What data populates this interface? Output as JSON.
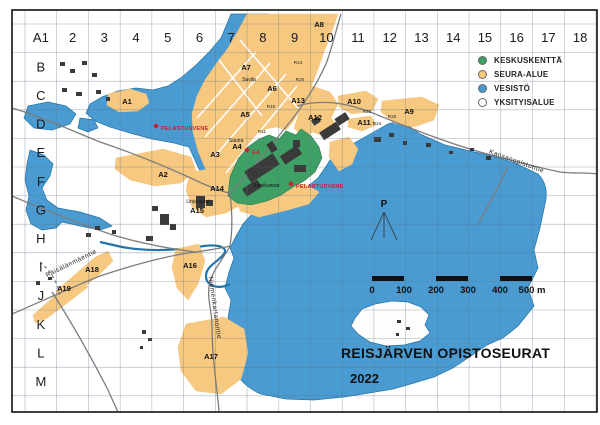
{
  "page": {
    "title_line": "REISJÄRVEN OPISTOSEURAT",
    "year": "2022"
  },
  "grid": {
    "columns": [
      "A1",
      "2",
      "3",
      "4",
      "5",
      "6",
      "7",
      "8",
      "9",
      "10",
      "11",
      "12",
      "13",
      "14",
      "15",
      "16",
      "17",
      "18"
    ],
    "rows": [
      "B",
      "C",
      "D",
      "E",
      "F",
      "G",
      "H",
      "I",
      "J",
      "K",
      "L",
      "M"
    ]
  },
  "legend": {
    "items": [
      {
        "label": "KESKUSKENTTÄ",
        "color": "#3fa065"
      },
      {
        "label": "SEURA-ALUE",
        "color": "#f6c880"
      },
      {
        "label": "VESISTÖ",
        "color": "#4a9bd1"
      },
      {
        "label": "YKSITYISALUE",
        "color": "#ffffff"
      }
    ]
  },
  "scale_bar": {
    "labels": [
      "0",
      "100",
      "200",
      "300",
      "400",
      "500 m"
    ]
  },
  "north_marker": {
    "label": "P",
    "x": 384,
    "y": 207
  },
  "map_labels": {
    "areas": [
      {
        "text": "A1",
        "x": 127,
        "y": 104
      },
      {
        "text": "A2",
        "x": 163,
        "y": 177
      },
      {
        "text": "A3",
        "x": 215,
        "y": 157
      },
      {
        "text": "A4",
        "x": 237,
        "y": 149
      },
      {
        "text": "A5",
        "x": 245,
        "y": 117
      },
      {
        "text": "A6",
        "x": 272,
        "y": 91
      },
      {
        "text": "A7",
        "x": 246,
        "y": 70
      },
      {
        "text": "A8",
        "x": 319,
        "y": 27
      },
      {
        "text": "A9",
        "x": 409,
        "y": 114
      },
      {
        "text": "A10",
        "x": 354,
        "y": 104
      },
      {
        "text": "A11",
        "x": 364,
        "y": 125
      },
      {
        "text": "A12",
        "x": 315,
        "y": 120
      },
      {
        "text": "A13",
        "x": 298,
        "y": 103
      },
      {
        "text": "A14",
        "x": 217,
        "y": 191
      },
      {
        "text": "A15",
        "x": 197,
        "y": 213
      },
      {
        "text": "A16",
        "x": 190,
        "y": 268
      },
      {
        "text": "A17",
        "x": 211,
        "y": 359
      },
      {
        "text": "A18",
        "x": 92,
        "y": 272
      },
      {
        "text": "A19",
        "x": 64,
        "y": 291
      }
    ],
    "route_points": [
      {
        "text": "R14",
        "x": 298,
        "y": 64
      },
      {
        "text": "R20",
        "x": 300,
        "y": 81
      },
      {
        "text": "R15",
        "x": 271,
        "y": 108
      },
      {
        "text": "R11",
        "x": 262,
        "y": 133
      },
      {
        "text": "R23",
        "x": 367,
        "y": 113
      },
      {
        "text": "R25",
        "x": 392,
        "y": 118
      },
      {
        "text": "R24",
        "x": 377,
        "y": 125
      }
    ],
    "poi": [
      {
        "text": "Suvila",
        "x": 249,
        "y": 81
      },
      {
        "text": "Sauna",
        "x": 236,
        "y": 142
      },
      {
        "text": "Toimikunnat",
        "x": 266,
        "y": 187
      },
      {
        "text": "Linja-autot",
        "x": 198,
        "y": 203
      }
    ],
    "alerts": [
      {
        "text": "PELASTUSVENE",
        "x": 161,
        "y": 130
      },
      {
        "text": "PELASTUSVENE",
        "x": 296,
        "y": 188
      },
      {
        "text": "EA",
        "x": 252,
        "y": 154
      }
    ],
    "roads": [
      {
        "text": "Kansanopistontie",
        "x": 516,
        "y": 163,
        "angle": 20
      },
      {
        "text": "Räisälänmäentie",
        "x": 72,
        "y": 265,
        "angle": -26
      },
      {
        "text": "Niemenkartanontie",
        "x": 213,
        "y": 308,
        "angle": 82
      }
    ]
  },
  "colors": {
    "water": "#4a9bd1",
    "shore": "#2273a8",
    "seura": "#f6c880",
    "keskus": "#3fa065",
    "building": "#3a3a3a",
    "alert": "#c22430",
    "road": "#7d7d7d",
    "grid": "#5c748a"
  }
}
